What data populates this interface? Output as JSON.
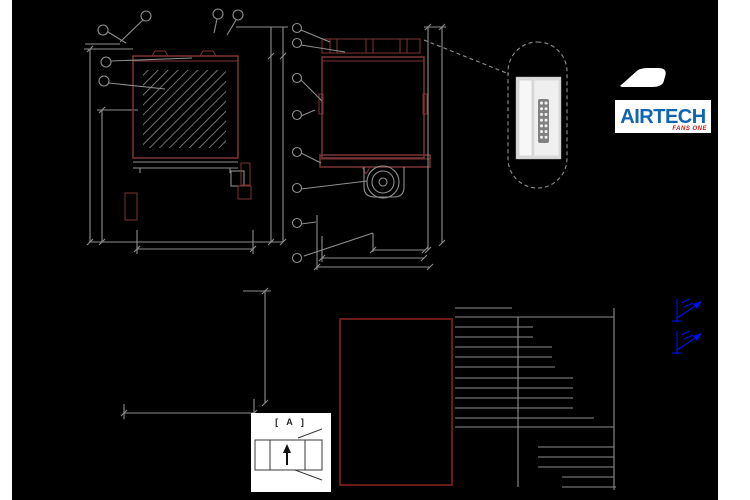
{
  "sheet": {
    "background": "#000000",
    "margin_color": "#ffffff"
  },
  "colors": {
    "line_gray": "#8e8e8e",
    "line_red": "#7b3434",
    "outline_red": "#6b1a1a",
    "hatch_gray": "#949494",
    "blue": "#0011ee",
    "logo_blue": "#1065b1",
    "logo_red": "#c41818"
  },
  "logo": {
    "brand": "AIRTECH",
    "tagline": "FANS ONE"
  },
  "detail_box": {
    "label": "[ A ]"
  },
  "views": {
    "front": {
      "callouts": 6
    },
    "side": {
      "callouts": 8
    }
  },
  "table": {
    "columns": 2,
    "h_lines": [
      [
        308,
        455,
        512
      ],
      [
        317,
        455,
        614
      ],
      [
        327,
        455,
        533
      ],
      [
        337,
        455,
        533
      ],
      [
        347,
        455,
        552
      ],
      [
        357,
        455,
        552
      ],
      [
        367,
        455,
        555
      ],
      [
        378,
        455,
        573
      ],
      [
        388,
        455,
        573
      ],
      [
        398,
        455,
        573
      ],
      [
        408,
        455,
        573
      ],
      [
        418,
        455,
        594
      ],
      [
        427,
        455,
        614
      ],
      [
        447,
        538,
        614
      ],
      [
        457,
        538,
        614
      ],
      [
        467,
        538,
        614
      ],
      [
        477,
        562,
        614
      ],
      [
        487,
        562,
        616
      ]
    ],
    "v_lines": [
      [
        518,
        317,
        487
      ],
      [
        614,
        308,
        490
      ]
    ]
  }
}
